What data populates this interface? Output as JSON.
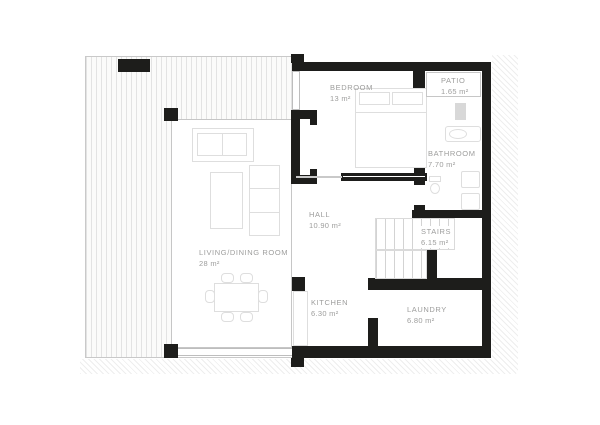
{
  "colors": {
    "background": "#ffffff",
    "wall": "#1d1d1b",
    "label": "#9d9d9c",
    "furniture_line": "#dedede",
    "hatch_line": "#e3e3e3",
    "glass_line": "#c6c6c6",
    "thin_line": "#c9c9c9"
  },
  "rooms": [
    {
      "name": "LIVING/DINING ROOM",
      "area": "28 m²"
    },
    {
      "name": "BEDROOM",
      "area": "13 m²"
    },
    {
      "name": "PATIO",
      "area": "1.65 m²"
    },
    {
      "name": "BATHROOM",
      "area": "7.70 m²"
    },
    {
      "name": "HALL",
      "area": "10.90 m²"
    },
    {
      "name": "STAIRS",
      "area": "6.15 m²"
    },
    {
      "name": "KITCHEN",
      "area": "6.30 m²"
    },
    {
      "name": "LAUNDRY",
      "area": "6.80 m²"
    }
  ]
}
